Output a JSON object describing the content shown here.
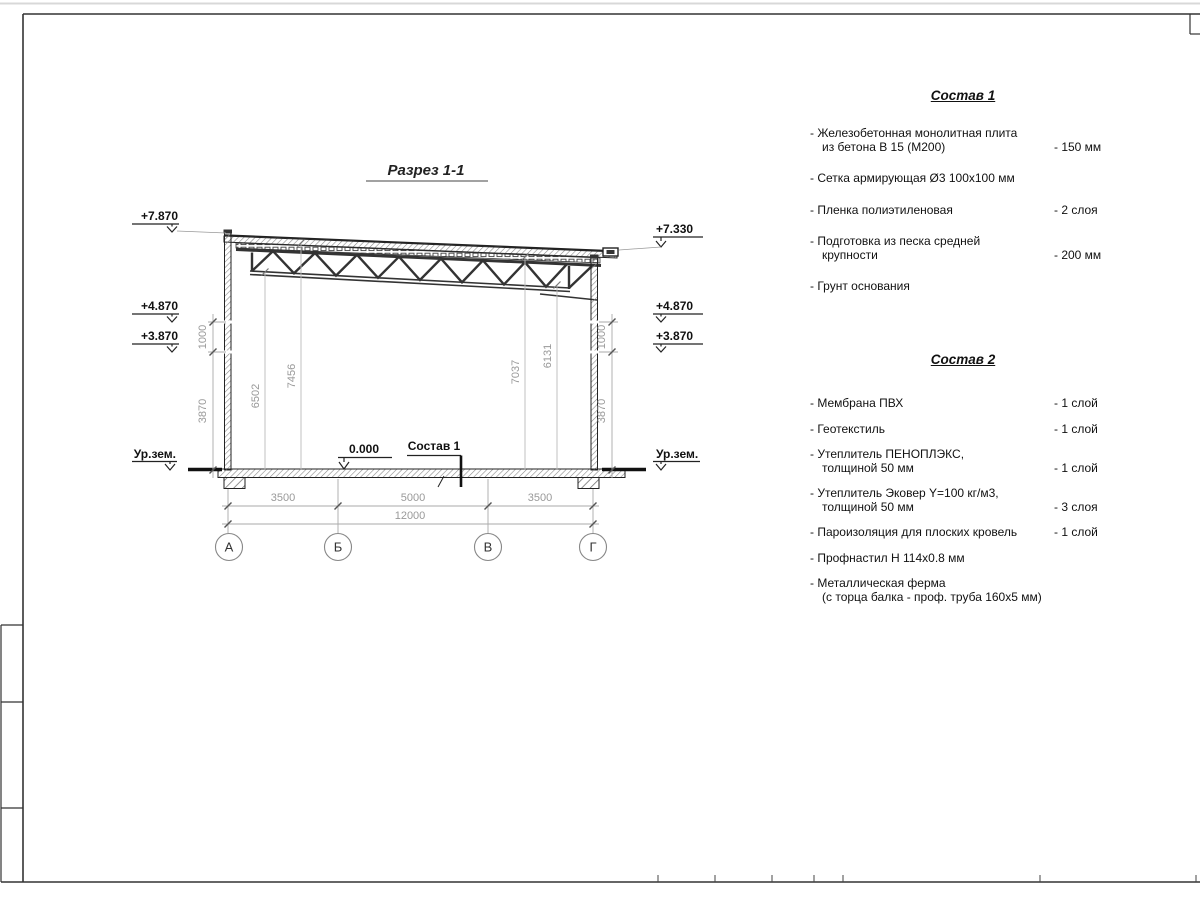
{
  "drawing": {
    "title": "Разрез 1-1",
    "elev": {
      "l7870": "+7.870",
      "l4870": "+4.870",
      "l3870": "+3.870",
      "l_ground": "Ур.зем.",
      "r7330": "+7.330",
      "r4870": "+4.870",
      "r3870": "+3.870",
      "r_ground": "Ур.зем."
    },
    "dims": {
      "l1000": "1000",
      "l3870": "3870",
      "r1000": "1000",
      "r3870": "3870",
      "v6502": "6502",
      "v7456": "7456",
      "v7037": "7037",
      "v6131": "6131",
      "b3500l": "3500",
      "b5000": "5000",
      "b3500r": "3500",
      "b12000": "12000"
    },
    "marks": {
      "zero": "0.000",
      "sostav_ref": "Состав 1"
    },
    "axes": {
      "a": "А",
      "b": "Б",
      "v": "В",
      "g": "Г"
    }
  },
  "sostav1": {
    "title": "Состав 1",
    "items": [
      {
        "name": "- Железобетонная  монолитная плита\nиз бетона В 15 (М200)",
        "qty": "- 150 мм"
      },
      {
        "name": "- Сетка армирующая Ø3 100х100 мм",
        "qty": ""
      },
      {
        "name": "- Пленка полиэтиленовая",
        "qty": "-  2 слоя"
      },
      {
        "name": "- Подготовка из песка средней\nкрупности",
        "qty": "- 200 мм"
      },
      {
        "name": "- Грунт основания",
        "qty": ""
      }
    ]
  },
  "sostav2": {
    "title": "Состав 2",
    "items": [
      {
        "name": "- Мембрана ПВХ",
        "qty": "- 1 слой"
      },
      {
        "name": "- Геотекстиль",
        "qty": "- 1 слой"
      },
      {
        "name": "- Утеплитель ПЕНОПЛЭКС,\nтолщиной 50 мм",
        "qty": "- 1 слой"
      },
      {
        "name": "- Утеплитель Эковер Y=100 кг/м3,\nтолщиной 50 мм",
        "qty": "- 3 слоя"
      },
      {
        "name": "- Пароизоляция для плоских кровель",
        "qty": "- 1 слой"
      },
      {
        "name": "- Профнастил Н 114х0.8 мм",
        "qty": ""
      },
      {
        "name": "- Металлическая ферма\n(с торца балка - проф. труба 160х5 мм)",
        "qty": ""
      }
    ]
  }
}
